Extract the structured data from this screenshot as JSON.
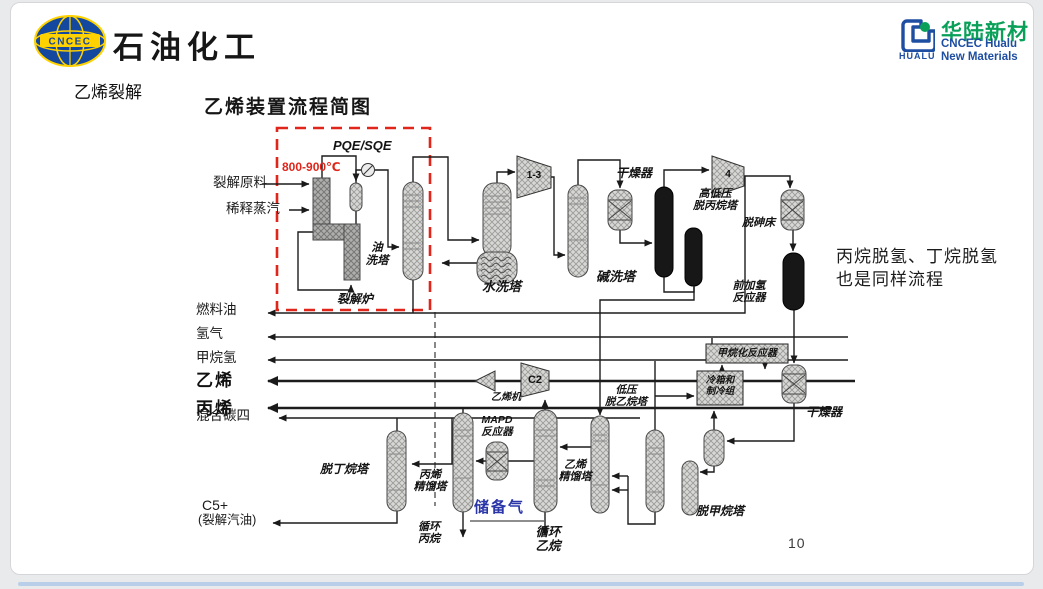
{
  "window": {
    "page_number": "10"
  },
  "header": {
    "brand_left": {
      "logo_text": "CNCEC",
      "company": "石油化工"
    },
    "section_label": "乙烯裂解",
    "title": "乙烯装置流程简图",
    "brand_right": {
      "cn": "华陆新材",
      "en1": "CNCEC Hualu",
      "en2": "New Materials",
      "icon_caption": "HUALU"
    }
  },
  "note": {
    "line1": "丙烷脱氢、丁烷脱氢",
    "line2": "也是同样流程"
  },
  "diagram": {
    "annotations": {
      "pqe_sqe": "PQE/SQE",
      "temperature": "800-900℃",
      "furnace_label": "裂解炉"
    },
    "feeds": {
      "cracking_feed": "裂解原料",
      "dilution_steam": "稀释蒸汽"
    },
    "products": {
      "fuel_oil": "燃料油",
      "hydrogen": "氢气",
      "methane_hydrogen": "甲烷氢",
      "ethylene": "乙烯",
      "propylene": "丙烯",
      "mixed_c4": "混合碳四",
      "c5": "C5+",
      "c5_note": "(裂解汽油)"
    },
    "recycle": {
      "storage_gas": "储备气",
      "propane_l1": "循环",
      "propane_l2": "丙烷",
      "ethane_l1": "循环",
      "ethane_l2": "乙烷"
    },
    "equipment": {
      "oil_wash_l1": "油",
      "oil_wash_l2": "洗塔",
      "water_wash": "水洗塔",
      "caustic_wash": "碱洗塔",
      "dryer1": "干燥器",
      "depropanizer_l1": "高低压",
      "depropanizer_l2": "脱丙烷塔",
      "dearsenication": "脱砷床",
      "front_hydrogenation_l1": "前加氢",
      "front_hydrogenation_l2": "反应器",
      "methanation": "甲烷化反应器",
      "coldbox_l1": "冷箱和",
      "coldbox_l2": "制冷组",
      "dryer2": "干燥器",
      "demethanizer": "脱甲烷塔",
      "deethanizer_l1": "低压",
      "deethanizer_l2": "脱乙烷塔",
      "ethylene_tower_l1": "乙烯",
      "ethylene_tower_l2": "精馏塔",
      "mapd_l1": "MAPD",
      "mapd_l2": "反应器",
      "propylene_tower_l1": "丙烯",
      "propylene_tower_l2": "精馏塔",
      "debutanizer": "脱丁烷塔",
      "compressor_1_3": "1-3",
      "compressor_4": "4",
      "compressor_c2": "C2",
      "ethylene_machine": "乙烯机"
    }
  },
  "colors": {
    "accent_red": "#e0251b",
    "storage_blue": "#2a35a8",
    "brand_blue": "#1e4ea1",
    "brand_green": "#0aa05a",
    "logo_blue": "#14489f",
    "logo_yellow": "#ffd200"
  }
}
